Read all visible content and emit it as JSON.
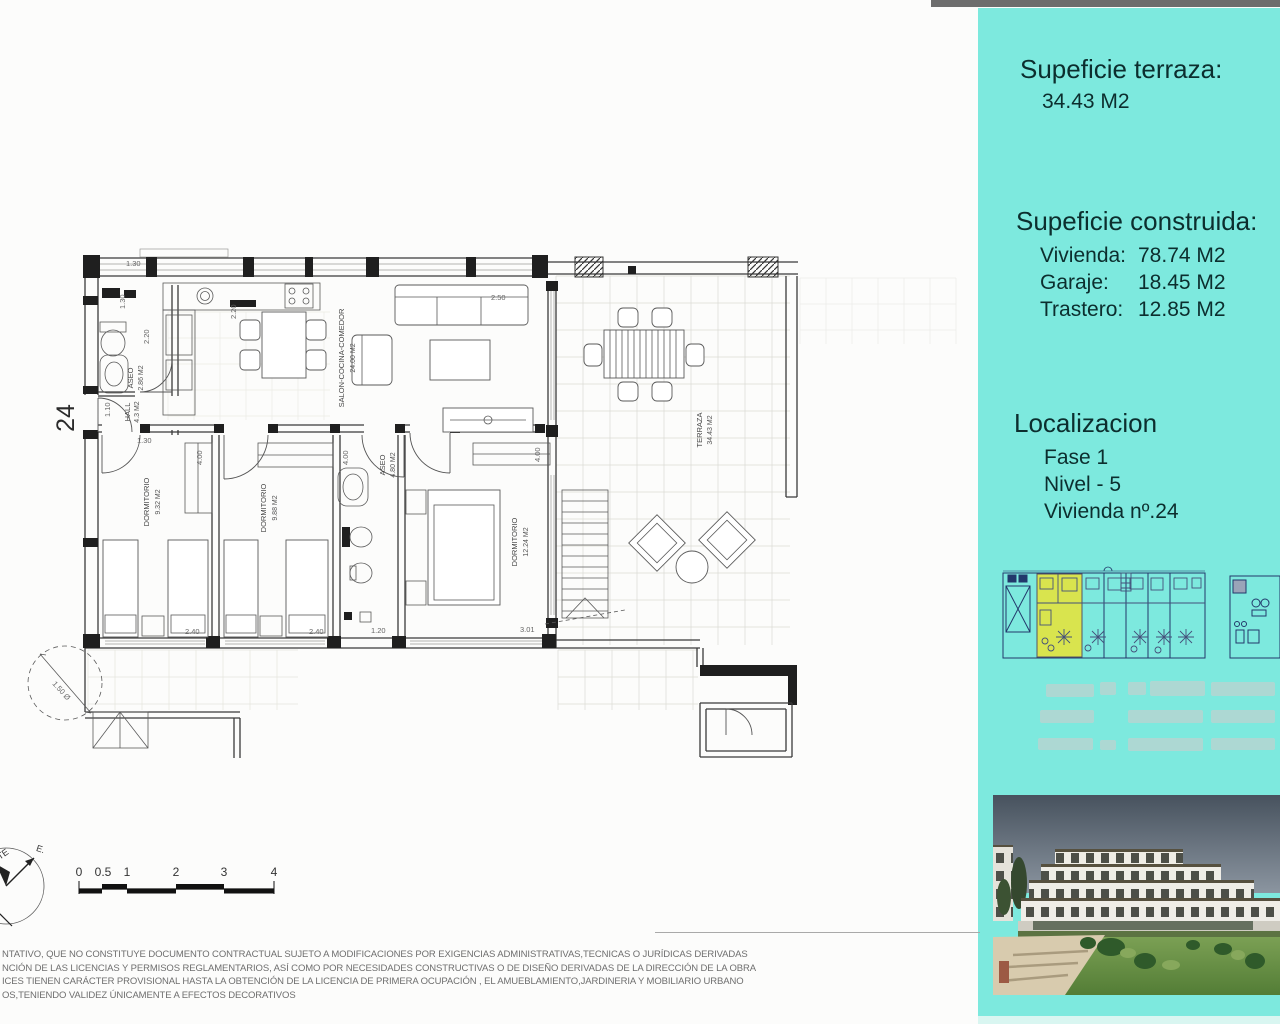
{
  "sidebar": {
    "terrace_title": "Supeficie terraza:",
    "terrace_value": "34.43 M2",
    "built_title": "Supeficie construida:",
    "built_rows": [
      {
        "label": "Vivienda:",
        "value": "78.74 M2"
      },
      {
        "label": "Garaje:",
        "value": "18.45 M2"
      },
      {
        "label": "Trastero:",
        "value": "12.85 M2"
      }
    ],
    "loc_title": "Localizacion",
    "loc_lines": [
      "Fase 1",
      "Nivel - 5",
      "Vivienda nº.24"
    ],
    "panel_color": "#7de9de",
    "highlight_color": "#d9e44e"
  },
  "plan": {
    "unit_number": "24",
    "rooms": {
      "aseo1": {
        "name": "ASEO",
        "area": "2.86 M2"
      },
      "hall": {
        "name": "HALL",
        "area": "4.3 M2"
      },
      "salon": {
        "name": "SALON-COCINA-COMEDOR",
        "area": "24.00 M2"
      },
      "dorm1": {
        "name": "DORMITORIO",
        "area": "9.32 M2"
      },
      "dorm2": {
        "name": "DORMITORIO",
        "area": "9.88 M2"
      },
      "aseo2": {
        "name": "ASEO",
        "area": "4.80 M2"
      },
      "dorm3": {
        "name": "DORMITORIO",
        "area": "12.24 M2"
      },
      "terraza": {
        "name": "TERRAZA",
        "area": "34.43 M2"
      }
    },
    "dims": [
      "1.30",
      "1.30",
      "2.20",
      "2.20",
      "1.10",
      "1.30",
      "4.00",
      "4.00",
      "4.00",
      "2.40",
      "2.40",
      "1.20",
      "3.01",
      "2.50",
      "1.50 Ø"
    ],
    "scale_labels": [
      "0",
      "0.5",
      "1",
      "2",
      "3",
      "4"
    ],
    "compass": {
      "te": "TE",
      "e": "E."
    }
  },
  "disclaimer": {
    "line1": "NTATIVO, QUE NO CONSTITUYE DOCUMENTO CONTRACTUAL SUJETO A MODIFICACIONES POR EXIGENCIAS ADMINISTRATIVAS,TECNICAS O JURÍDICAS DERIVADAS",
    "line2": "NCIÓN DE LAS LICENCIAS Y PERMISOS REGLAMENTARIOS, ASÍ COMO POR NECESIDADES CONSTRUCTIVAS O DE DISEÑO DERIVADAS DE LA DIRECCIÓN DE LA OBRA",
    "line3": "ICES TIENEN CARÁCTER PROVISIONAL HASTA LA OBTENCIÓN DE LA LICENCIA DE PRIMERA OCUPACIÓN , EL AMUEBLAMIENTO,JARDINERIA Y MOBILIARIO URBANO",
    "line4": "OS,TENIENDO VALIDEZ ÚNICAMENTE A EFECTOS DECORATIVOS"
  }
}
